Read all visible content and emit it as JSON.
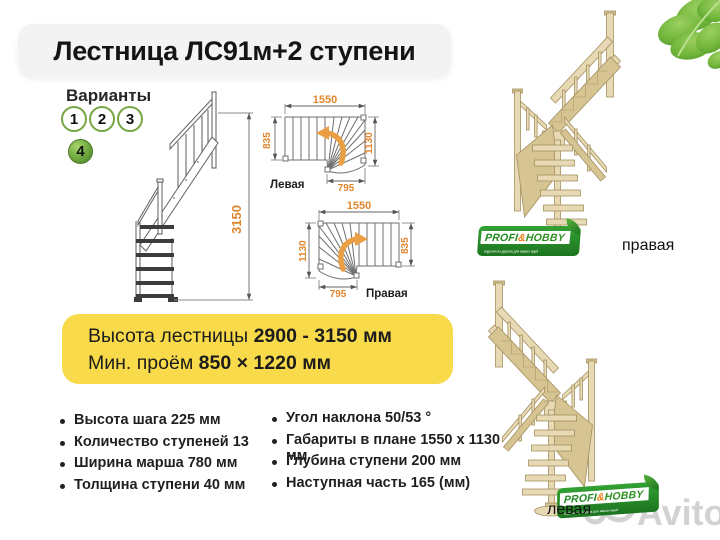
{
  "page": {
    "title": "Лестница ЛС91м+2 ступени"
  },
  "variants": {
    "heading": "Варианты",
    "items": [
      {
        "n": "1"
      },
      {
        "n": "2"
      },
      {
        "n": "3"
      },
      {
        "n": "4"
      }
    ],
    "selected": "4"
  },
  "side_view": {
    "height": "3150"
  },
  "plan_left": {
    "top": "1550",
    "left": "835",
    "right": "1130",
    "bottom": "795",
    "label": "Левая"
  },
  "plan_right": {
    "top": "1550",
    "left": "1130",
    "right": "835",
    "bottom": "795",
    "label": "Правая"
  },
  "highlight": {
    "line1_label": "Высота лестницы ",
    "line1_value": "2900 - 3150 мм",
    "line2_label": "Мин. проём ",
    "line2_value": " 850 × 1220 мм"
  },
  "specs_left": [
    "Высота шага 225 мм",
    "Количество ступеней 13",
    "Ширина марша 780 мм",
    "Толщина ступени 40 мм"
  ],
  "specs_right": [
    "Угол наклона 50/53 °",
    "Габариты в плане 1550 х 1130 мм",
    "Глубина ступени 200 мм",
    "Наступная часть 165 (мм)"
  ],
  "photo_top": {
    "label": "правая"
  },
  "photo_bottom": {
    "label": "левая"
  },
  "brand": {
    "name_a": "PROFI",
    "amp": "&",
    "name_b": "HOBBY",
    "tagline": "изделия из дерева для ваших идей"
  },
  "watermark": {
    "text": "Avito"
  },
  "colors": {
    "accent_orange": "#e2862e",
    "variant_green": "#77a743",
    "banner_yellow": "#f8da4a",
    "wood_beige": "#e6d9b4",
    "logo_green": "#2e9b33"
  }
}
